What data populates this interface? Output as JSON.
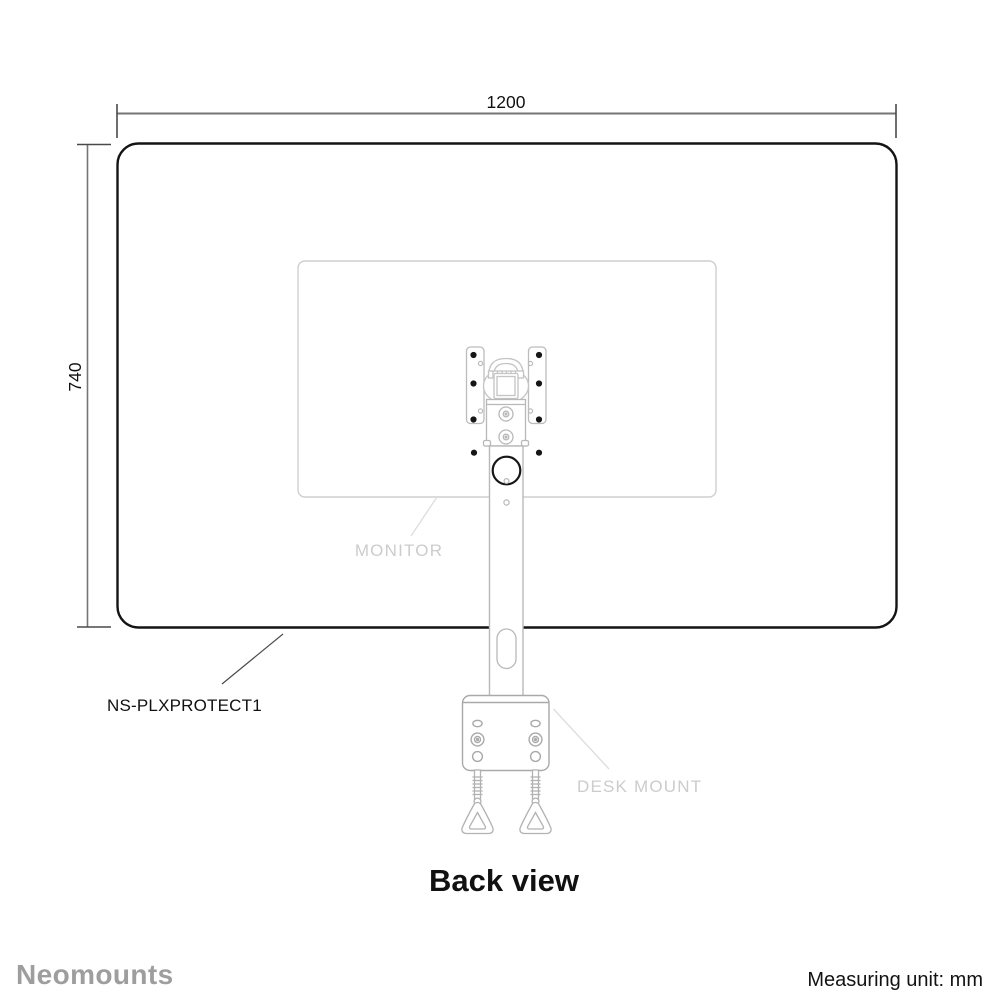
{
  "diagram": {
    "view_title": "Back view",
    "product_code": "NS-PLXPROTECT1",
    "dimension_width": "1200",
    "dimension_height": "740",
    "part_labels": {
      "monitor": "MONITOR",
      "desk_mount": "DESK MOUNT"
    }
  },
  "footer": {
    "brand": "Neomounts",
    "measuring_unit": "Measuring unit: mm"
  },
  "colors": {
    "screen_outline": "#141414",
    "dimension_line": "#757575",
    "dimension_tick": "#4a4a4a",
    "part_gray": "#b8b8b8",
    "light_part_gray": "#cfcfcf",
    "label_gray": "#cccccc",
    "brand_gray": "#9e9e9e"
  }
}
